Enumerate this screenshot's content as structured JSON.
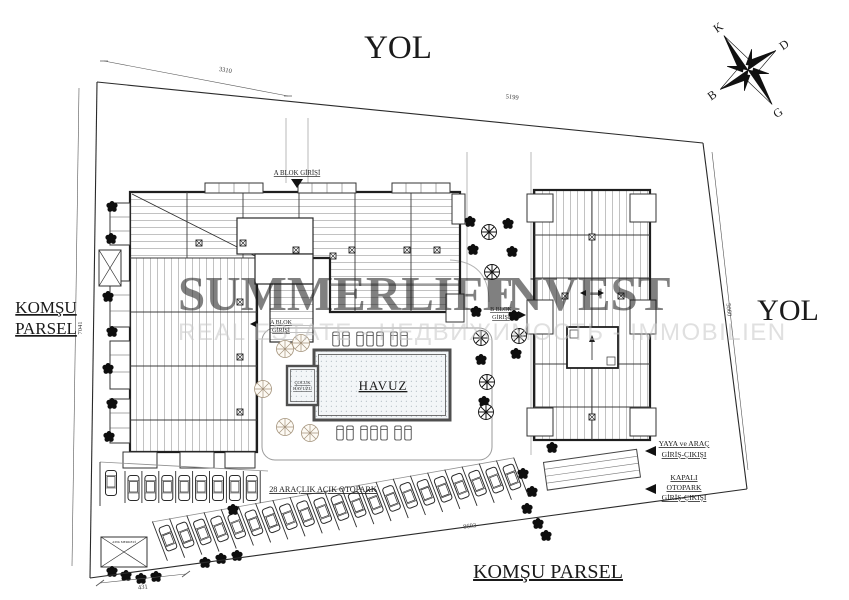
{
  "labels": {
    "road_top": "YOL",
    "road_right": "YOL",
    "neighbor_left_line1": "KOMŞU",
    "neighbor_left_line2": "PARSEL",
    "neighbor_bottom": "KOMŞU PARSEL",
    "a_block_entrance_top": "A BLOK GİRİŞİ",
    "a_block_entrance_side_line1": "A BLOK",
    "a_block_entrance_side_line2": "GİRİŞİ",
    "b_block_entrance_line1": "B BLOK",
    "b_block_entrance_line2": "GİRİŞİ",
    "pool": "HAVUZ",
    "kids_pool_line1": "ÇOCUK",
    "kids_pool_line2": "HAVUZU",
    "open_parking": "28 ARAÇLIK AÇIK OTOPARK",
    "pedestrian_vehicle_entry_line1": "YAYA ve ARAÇ",
    "pedestrian_vehicle_entry_line2": "GİRİŞ-ÇIKIŞI",
    "closed_parking_line1": "KAPALI",
    "closed_parking_line2": "OTOPARK",
    "closed_parking_line3": "GİRİŞ-ÇIKIŞI",
    "waste_box": "ATIK MERKEZİ"
  },
  "dimensions": {
    "top_left_segment": "3310",
    "top_edge": "5199",
    "left_edge": "7041",
    "right_edge": "5060",
    "bottom_edge": "8693",
    "bottom_left_segment": "431"
  },
  "compass": {
    "north": "K",
    "east": "D",
    "south": "G",
    "west": "B"
  },
  "watermark": {
    "brand_word1": "SUMMERLIFE",
    "brand_word2": "INVEST",
    "subtitle": "REAL ESTATE - НЕДВИЖИМОСТЬ - IMMOBILIEN"
  },
  "colors": {
    "ink": "#1c1c1c",
    "hatch": "#8a8a8a",
    "pool_dot": "#93a1ab",
    "watermark_gray": "#a6a6a6",
    "watermark_red": "#dd8f8f",
    "watermark_subtitle": "#c7c7c7"
  }
}
